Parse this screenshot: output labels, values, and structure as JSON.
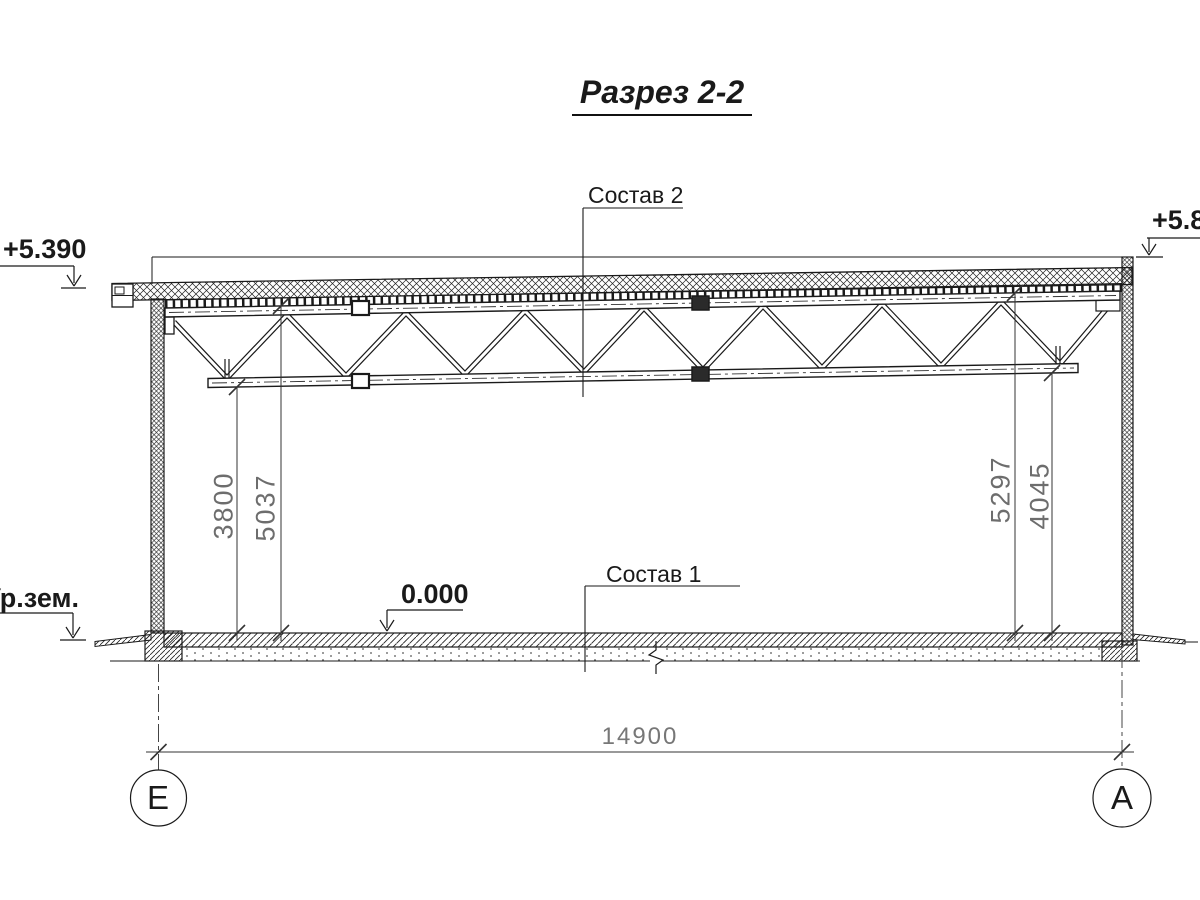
{
  "title": "Разрез 2-2",
  "callouts": {
    "roof_composition": "Состав 2",
    "floor_composition": "Состав 1"
  },
  "elevations": {
    "roof_left": "+5.390",
    "parapet_right": "+5.87",
    "floor_zero": "0.000",
    "ground": "Ур.зем."
  },
  "dimensions": {
    "left_floor_to_truss_bottom": "3800",
    "left_floor_to_truss_top": "5037",
    "right_floor_to_truss_top": "5297",
    "right_floor_to_truss_bottom": "4045",
    "overall_span": "14900"
  },
  "axes": {
    "left_letter": "Е",
    "right_letter": "А"
  },
  "colors": {
    "line": "#1a1a1a",
    "dim_text": "#6d6d6d",
    "background": "#ffffff"
  }
}
